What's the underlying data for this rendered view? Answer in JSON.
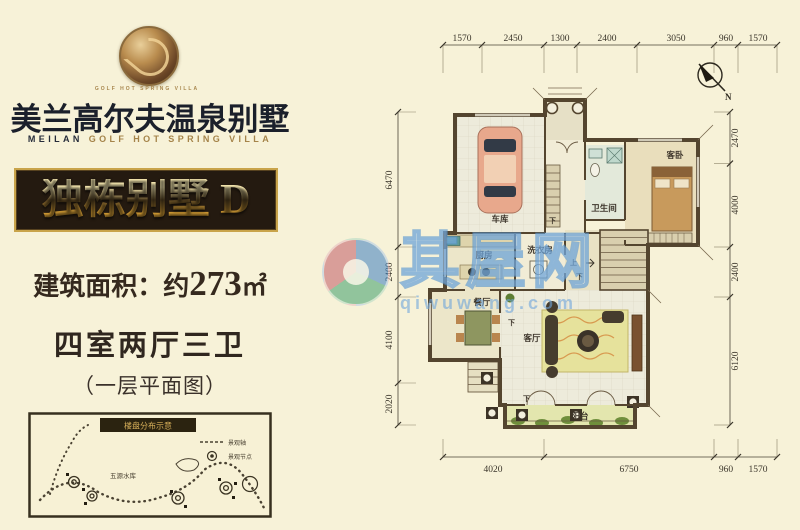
{
  "brand": {
    "title": "美兰高尔夫温泉别墅",
    "subtitle_primary": "MEILAN",
    "subtitle_secondary": " GOLF HOT SPRING VILLA",
    "logo_caption": "GOLF HOT SPRING VILLA"
  },
  "badge": {
    "label": "独栋别墅 D"
  },
  "specs": {
    "area_prefix": "建筑面积：约",
    "area_value": "273",
    "area_unit": "㎡",
    "rooms": "四室两厅三卫",
    "floor_note": "（一层平面图）"
  },
  "floor_plan": {
    "north_label": "N",
    "dims_top": [
      "1570",
      "2450",
      "1300",
      "2400",
      "3050",
      "960",
      "1570"
    ],
    "dims_bottom": [
      "4020",
      "6750",
      "960",
      "1570"
    ],
    "dims_left": [
      "6470",
      "2400",
      "4100",
      "2020"
    ],
    "dims_right": [
      "2470",
      "4000",
      "2400",
      "6120"
    ],
    "rooms": [
      {
        "label": "车库"
      },
      {
        "label": "卫生间"
      },
      {
        "label": "客卧"
      },
      {
        "label": "厨房"
      },
      {
        "label": "洗衣房"
      },
      {
        "label": "餐厅"
      },
      {
        "label": "客厅"
      },
      {
        "label": "阳台"
      }
    ],
    "stair_up": "上",
    "stair_down": "下"
  },
  "site_map": {
    "title": "楼盘分布示意",
    "legend_axis": "景观轴",
    "legend_node": "景观节点",
    "area_label": "五源水库"
  },
  "watermark": {
    "name": "其屋网",
    "domain": "qiwuwang.com"
  },
  "colors": {
    "background": "#f7f2d8",
    "accent_gold": "#c9a44a",
    "badge_bg": "#241a10",
    "wall": "#54452f"
  }
}
